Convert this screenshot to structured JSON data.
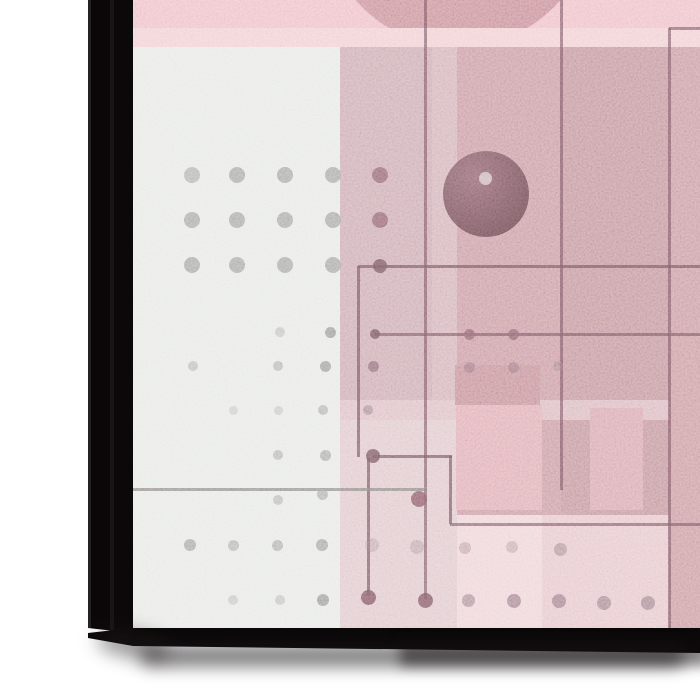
{
  "scene": {
    "description": "corner view of a stretched-canvas art print mockup, abstract geometric composition in pinks and grays",
    "palette": {
      "page-bg": "#ffffff",
      "frame-black": "#0b0809",
      "frame-edge-line": "#242223",
      "canvas-base": "#e2c0c5",
      "accent-rose": "#c28b94",
      "accent-gray": "#e4e6e1",
      "line-color": "#6a545c",
      "dot-gray": "#92928b",
      "sphere-dark": "#5e454b"
    }
  },
  "artwork": {
    "offset": {
      "x": 133,
      "y": 0
    },
    "size": {
      "w": 567,
      "h": 628
    },
    "elements": [
      {
        "t": "rect",
        "n": "art-base",
        "x": 133,
        "y": 0,
        "w": 567,
        "h": 628,
        "c": "#e2c0c5"
      },
      {
        "t": "rect",
        "n": "top-pink-band",
        "x": 133,
        "y": 0,
        "w": 567,
        "h": 28,
        "c": "#ecb5bf"
      },
      {
        "t": "circle",
        "n": "red-circle",
        "x": 458,
        "y": -88,
        "r": 135,
        "c": "#cb8790",
        "c2": "#bc7a84"
      },
      {
        "t": "rect",
        "n": "light-pink-band",
        "x": 133,
        "y": 28,
        "w": 567,
        "h": 19,
        "c": "#efc7cc"
      },
      {
        "t": "rect",
        "n": "gray-panel",
        "x": 133,
        "y": 47,
        "w": 207,
        "h": 581,
        "c": "#e4e6e1"
      },
      {
        "t": "rect",
        "n": "mauve-band",
        "x": 340,
        "y": 47,
        "w": 117,
        "h": 353,
        "c": "#c59ea6"
      },
      {
        "t": "rect",
        "n": "mauve-sliver",
        "x": 432,
        "y": 47,
        "w": 25,
        "h": 353,
        "c": "#cda7ae",
        "o": 0.9
      },
      {
        "t": "rect",
        "n": "rose-main-field",
        "x": 457,
        "y": 47,
        "w": 243,
        "h": 468,
        "c": "#c28b94"
      },
      {
        "t": "rect",
        "n": "rose-dark-column",
        "x": 561,
        "y": 47,
        "w": 108,
        "h": 468,
        "c": "#b9848c",
        "o": 0.9
      },
      {
        "t": "rect",
        "n": "below-mauve-field",
        "x": 340,
        "y": 400,
        "w": 117,
        "h": 228,
        "c": "#dcc0c4"
      },
      {
        "t": "rect",
        "n": "light-horizontal-strip",
        "x": 340,
        "y": 400,
        "w": 360,
        "h": 20,
        "c": "#d8b4ba",
        "o": 0.9
      },
      {
        "t": "rect",
        "n": "rose-block-upper",
        "x": 455,
        "y": 365,
        "w": 85,
        "h": 40,
        "c": "#bb7f88"
      },
      {
        "t": "rect",
        "n": "salmon-block",
        "x": 456,
        "y": 405,
        "w": 86,
        "h": 105,
        "c": "#dba1aa"
      },
      {
        "t": "rect",
        "n": "rose-block-right",
        "x": 590,
        "y": 408,
        "w": 53,
        "h": 102,
        "c": "#d39aa3"
      },
      {
        "t": "rect",
        "n": "bottom-pale-field",
        "x": 457,
        "y": 515,
        "w": 243,
        "h": 113,
        "c": "#e3bec3"
      },
      {
        "t": "rect",
        "n": "pale-bottom-column",
        "x": 457,
        "y": 515,
        "w": 85,
        "h": 113,
        "c": "#ebced2",
        "o": 0.9
      },
      {
        "t": "rect",
        "n": "right-edge-column",
        "x": 669,
        "y": 333,
        "w": 31,
        "h": 295,
        "c": "#c48b93"
      },
      {
        "t": "circle",
        "n": "dark-sphere",
        "x": 486,
        "y": 194,
        "r": 43,
        "c": "#7e636b",
        "c2": "#5e454b",
        "o": 0.96
      },
      {
        "t": "dot",
        "n": "sphere-highlight",
        "x": 485,
        "y": 178,
        "r": 6.5,
        "c": "#c9aeb3",
        "o": 0.95
      },
      {
        "t": "hl",
        "n": "line-top-right",
        "x1": 669,
        "x2": 700,
        "y": 28,
        "c": "#6a545c",
        "o": 0.8
      },
      {
        "t": "vl",
        "n": "line-vert-669",
        "x": 669,
        "y1": 28,
        "y2": 628,
        "c": "#6a545c",
        "o": 0.8
      },
      {
        "t": "vl",
        "n": "line-vert-561",
        "x": 561,
        "y1": 0,
        "y2": 490,
        "c": "#6a545c",
        "o": 0.8
      },
      {
        "t": "vl",
        "n": "line-vert-425",
        "x": 425,
        "y1": 0,
        "y2": 599,
        "c": "#6a545c",
        "o": 0.8
      },
      {
        "t": "hl",
        "n": "line-h-266",
        "x1": 358,
        "x2": 700,
        "y": 266,
        "c": "#6a545c",
        "o": 0.85
      },
      {
        "t": "vl",
        "n": "line-vert-358",
        "x": 358,
        "y1": 266,
        "y2": 457,
        "c": "#6a545c",
        "o": 0.85
      },
      {
        "t": "hl",
        "n": "line-h-334",
        "x1": 375,
        "x2": 700,
        "y": 334,
        "c": "#6a545c",
        "o": 0.8
      },
      {
        "t": "hl",
        "n": "line-h-456",
        "x1": 373,
        "x2": 452,
        "y": 456,
        "c": "#6a545c",
        "o": 0.85
      },
      {
        "t": "vl",
        "n": "line-vert-450",
        "x": 450,
        "y1": 456,
        "y2": 524,
        "c": "#6a545c",
        "o": 0.85
      },
      {
        "t": "hl",
        "n": "line-h-524",
        "x1": 450,
        "x2": 700,
        "y": 524,
        "c": "#6a545c",
        "o": 0.8
      },
      {
        "t": "vl",
        "n": "line-vert-368",
        "x": 368,
        "y1": 458,
        "y2": 596,
        "c": "#6a545c",
        "o": 0.85
      },
      {
        "t": "hl",
        "n": "line-h-489",
        "x1": 133,
        "x2": 425,
        "y": 489,
        "c": "#77716f",
        "o": 0.85
      },
      {
        "t": "dot",
        "n": "node-dot",
        "x": 380,
        "y": 266,
        "r": 7,
        "c": "#6a545c",
        "o": 0.9
      },
      {
        "t": "dot",
        "n": "node-dot",
        "x": 375,
        "y": 334,
        "r": 5,
        "c": "#6a545c",
        "o": 0.9
      },
      {
        "t": "dot",
        "n": "node-dot",
        "x": 469,
        "y": 334,
        "r": 5.5,
        "c": "#7a5d65",
        "o": 0.85
      },
      {
        "t": "dot",
        "n": "node-dot",
        "x": 513,
        "y": 334,
        "r": 5.5,
        "c": "#7a5d65",
        "o": 0.85
      },
      {
        "t": "dot",
        "n": "node-dot",
        "x": 373,
        "y": 456,
        "r": 7,
        "c": "#6a545c",
        "o": 0.9
      },
      {
        "t": "dot",
        "n": "node-dot",
        "x": 419,
        "y": 499,
        "r": 8,
        "c": "#75575f",
        "o": 0.9
      },
      {
        "t": "dot",
        "n": "node-dot",
        "x": 368,
        "y": 597,
        "r": 7.5,
        "c": "#6f545c",
        "o": 0.9
      },
      {
        "t": "dot",
        "n": "node-dot",
        "x": 425,
        "y": 600,
        "r": 7.5,
        "c": "#6f545c",
        "o": 0.9
      },
      {
        "t": "dot",
        "n": "grid-dot",
        "x": 192,
        "y": 175,
        "r": 8,
        "c": "#92928b",
        "o": 0.7
      },
      {
        "t": "dot",
        "n": "grid-dot",
        "x": 237,
        "y": 175,
        "r": 8,
        "c": "#92928b",
        "o": 0.85
      },
      {
        "t": "dot",
        "n": "grid-dot",
        "x": 285,
        "y": 175,
        "r": 8,
        "c": "#92928b",
        "o": 0.85
      },
      {
        "t": "dot",
        "n": "grid-dot",
        "x": 333,
        "y": 175,
        "r": 8,
        "c": "#92928b",
        "o": 0.85
      },
      {
        "t": "dot",
        "n": "grid-dot",
        "x": 380,
        "y": 175,
        "r": 8,
        "c": "#7e6169",
        "o": 0.9
      },
      {
        "t": "dot",
        "n": "grid-dot",
        "x": 192,
        "y": 220,
        "r": 8,
        "c": "#92928b",
        "o": 0.85
      },
      {
        "t": "dot",
        "n": "grid-dot",
        "x": 237,
        "y": 220,
        "r": 8,
        "c": "#92928b",
        "o": 0.85
      },
      {
        "t": "dot",
        "n": "grid-dot",
        "x": 285,
        "y": 220,
        "r": 8,
        "c": "#92928b",
        "o": 0.85
      },
      {
        "t": "dot",
        "n": "grid-dot",
        "x": 333,
        "y": 220,
        "r": 8,
        "c": "#92928b",
        "o": 0.85
      },
      {
        "t": "dot",
        "n": "grid-dot",
        "x": 380,
        "y": 220,
        "r": 8,
        "c": "#7e6169",
        "o": 0.9
      },
      {
        "t": "dot",
        "n": "grid-dot",
        "x": 192,
        "y": 265,
        "r": 8,
        "c": "#92928b",
        "o": 0.85
      },
      {
        "t": "dot",
        "n": "grid-dot",
        "x": 237,
        "y": 265,
        "r": 8,
        "c": "#92928b",
        "o": 0.85
      },
      {
        "t": "dot",
        "n": "grid-dot",
        "x": 285,
        "y": 265,
        "r": 8,
        "c": "#92928b",
        "o": 0.85
      },
      {
        "t": "dot",
        "n": "grid-dot",
        "x": 333,
        "y": 265,
        "r": 8,
        "c": "#92928b",
        "o": 0.85
      },
      {
        "t": "dot",
        "n": "scatter-dot",
        "x": 280,
        "y": 332,
        "r": 5,
        "c": "#8f8f88",
        "o": 0.45
      },
      {
        "t": "dot",
        "n": "scatter-dot",
        "x": 330,
        "y": 332,
        "r": 5.5,
        "c": "#878780",
        "o": 0.9
      },
      {
        "t": "dot",
        "n": "scatter-dot",
        "x": 193,
        "y": 366,
        "r": 5,
        "c": "#90908a",
        "o": 0.55
      },
      {
        "t": "dot",
        "n": "scatter-dot",
        "x": 278,
        "y": 366,
        "r": 5,
        "c": "#90908a",
        "o": 0.6
      },
      {
        "t": "dot",
        "n": "scatter-dot",
        "x": 325,
        "y": 366,
        "r": 5.5,
        "c": "#878780",
        "o": 0.85
      },
      {
        "t": "dot",
        "n": "scatter-dot",
        "x": 373,
        "y": 366,
        "r": 5.5,
        "c": "#7a626a",
        "o": 0.85
      },
      {
        "t": "dot",
        "n": "scatter-dot",
        "x": 233,
        "y": 410,
        "r": 4.5,
        "c": "#90908a",
        "o": 0.35
      },
      {
        "t": "dot",
        "n": "scatter-dot",
        "x": 278,
        "y": 410,
        "r": 4.5,
        "c": "#90908a",
        "o": 0.4
      },
      {
        "t": "dot",
        "n": "scatter-dot",
        "x": 323,
        "y": 410,
        "r": 5,
        "c": "#8b8b84",
        "o": 0.6
      },
      {
        "t": "dot",
        "n": "scatter-dot",
        "x": 368,
        "y": 410,
        "r": 5,
        "c": "#7d656d",
        "o": 0.6
      },
      {
        "t": "dot",
        "n": "scatter-dot",
        "x": 278,
        "y": 455,
        "r": 5,
        "c": "#8d8d86",
        "o": 0.6
      },
      {
        "t": "dot",
        "n": "scatter-dot",
        "x": 325,
        "y": 455,
        "r": 5.5,
        "c": "#8a8a83",
        "o": 0.7
      },
      {
        "t": "dot",
        "n": "scatter-dot",
        "x": 278,
        "y": 500,
        "r": 5,
        "c": "#8d8d86",
        "o": 0.55
      },
      {
        "t": "dot",
        "n": "scatter-dot",
        "x": 322,
        "y": 494,
        "r": 5.5,
        "c": "#8a8a83",
        "o": 0.65
      },
      {
        "t": "dot",
        "n": "scatter-dot",
        "x": 190,
        "y": 545,
        "r": 6,
        "c": "#878780",
        "o": 0.75
      },
      {
        "t": "dot",
        "n": "scatter-dot",
        "x": 233,
        "y": 545,
        "r": 5.5,
        "c": "#8a8a83",
        "o": 0.6
      },
      {
        "t": "dot",
        "n": "scatter-dot",
        "x": 277,
        "y": 545,
        "r": 5.5,
        "c": "#8a8a83",
        "o": 0.65
      },
      {
        "t": "dot",
        "n": "scatter-dot",
        "x": 322,
        "y": 545,
        "r": 6,
        "c": "#85857e",
        "o": 0.75
      },
      {
        "t": "dot",
        "n": "scatter-dot",
        "x": 233,
        "y": 600,
        "r": 5,
        "c": "#8d8d86",
        "o": 0.4
      },
      {
        "t": "dot",
        "n": "scatter-dot",
        "x": 280,
        "y": 600,
        "r": 5,
        "c": "#8d8d86",
        "o": 0.45
      },
      {
        "t": "dot",
        "n": "scatter-dot",
        "x": 323,
        "y": 600,
        "r": 6,
        "c": "#82827b",
        "o": 0.85
      },
      {
        "t": "dot",
        "n": "scatter-dot",
        "x": 372,
        "y": 545,
        "r": 7,
        "c": "#8b6f77",
        "o": 0.35
      },
      {
        "t": "dot",
        "n": "scatter-dot",
        "x": 417,
        "y": 547,
        "r": 7,
        "c": "#8b6f77",
        "o": 0.4
      },
      {
        "t": "dot",
        "n": "scatter-dot",
        "x": 469,
        "y": 367,
        "r": 5.5,
        "c": "#8a6c74",
        "o": 0.7
      },
      {
        "t": "dot",
        "n": "scatter-dot",
        "x": 513,
        "y": 367,
        "r": 5.5,
        "c": "#8a6c74",
        "o": 0.7
      },
      {
        "t": "dot",
        "n": "scatter-dot",
        "x": 558,
        "y": 366,
        "r": 5,
        "c": "#8a6c74",
        "o": 0.5
      },
      {
        "t": "dot",
        "n": "scatter-dot",
        "x": 465,
        "y": 548,
        "r": 6,
        "c": "#a07b84",
        "o": 0.55
      },
      {
        "t": "dot",
        "n": "scatter-dot",
        "x": 512,
        "y": 547,
        "r": 6,
        "c": "#a07b84",
        "o": 0.5
      },
      {
        "t": "dot",
        "n": "scatter-dot",
        "x": 560,
        "y": 549,
        "r": 6.5,
        "c": "#97737c",
        "o": 0.7
      },
      {
        "t": "dot",
        "n": "scatter-dot",
        "x": 468,
        "y": 600,
        "r": 6.5,
        "c": "#8d6b74",
        "o": 0.7
      },
      {
        "t": "dot",
        "n": "scatter-dot",
        "x": 514,
        "y": 601,
        "r": 7,
        "c": "#8a6871",
        "o": 0.8
      },
      {
        "t": "dot",
        "n": "scatter-dot",
        "x": 559,
        "y": 601,
        "r": 7,
        "c": "#8a6871",
        "o": 0.8
      },
      {
        "t": "dot",
        "n": "scatter-dot",
        "x": 604,
        "y": 603,
        "r": 7,
        "c": "#8a6871",
        "o": 0.75
      },
      {
        "t": "dot",
        "n": "scatter-dot",
        "x": 648,
        "y": 603,
        "r": 7,
        "c": "#8a6871",
        "o": 0.75
      }
    ]
  }
}
